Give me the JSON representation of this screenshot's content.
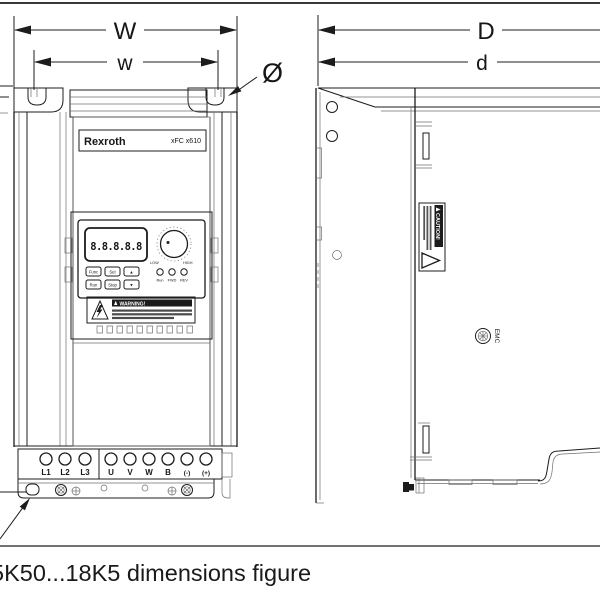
{
  "figure": {
    "caption": "5K50...18K5 dimensions figure"
  },
  "dimension_labels": {
    "front_outer_width": "W",
    "front_hole_width": "w",
    "hole_diameter": "Ø",
    "side_outer_depth": "D",
    "side_hole_depth": "d"
  },
  "front_view": {
    "brand": "Rexroth",
    "model": "xFC x610",
    "display_value": "8.8.8.8.8",
    "knob_low": "LOW",
    "knob_high": "HIGH",
    "buttons": {
      "func": "Func",
      "set": "Set",
      "up": "▲",
      "run": "Run",
      "stop": "Stop",
      "down": "▼"
    },
    "leds": [
      "Run",
      "FWD",
      "REV"
    ],
    "warning_title": "WARNING!",
    "terminals_input": [
      "L1",
      "L2",
      "L3"
    ],
    "terminals_output": [
      "U",
      "V",
      "W",
      "B",
      "(-)",
      "(+)"
    ]
  },
  "side_view": {
    "caution_title": "CAUTION!",
    "emc_label": "EMC"
  }
}
